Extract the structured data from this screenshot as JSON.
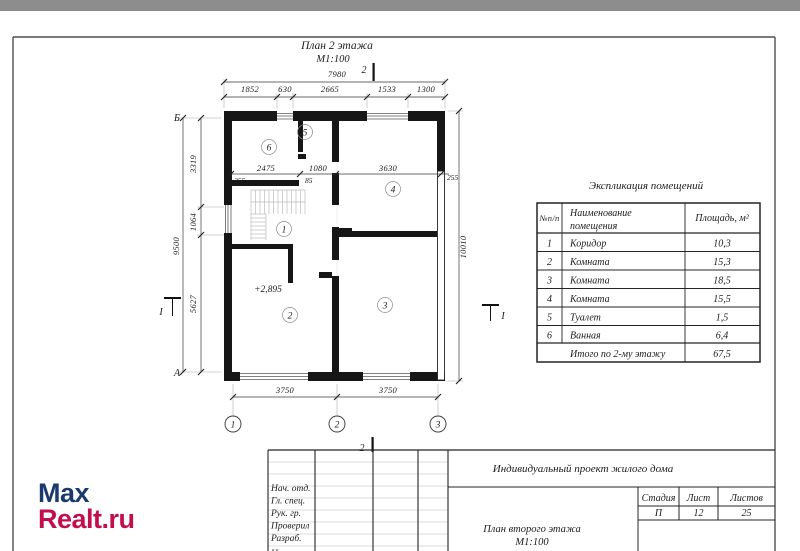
{
  "sheet": {
    "top_strip_color": "#8d8d8d"
  },
  "logo": {
    "word1": "Max",
    "word2": "Realt.ru",
    "color1": "#1a3a6e",
    "color2": "#c30e4d"
  },
  "plan": {
    "title": "План 2 этажа",
    "scale": "М1:100",
    "elevation": "+2,895",
    "axis_letters": [
      "Б",
      "А"
    ],
    "axis_numbers": [
      "1",
      "2",
      "3"
    ],
    "section_vertical": "2",
    "section_horizontal": "I",
    "rooms": [
      "1",
      "2",
      "3",
      "4",
      "5",
      "6"
    ],
    "dims": {
      "top_overall": "7980",
      "top_segments": [
        "1852",
        "630",
        "2665",
        "1533",
        "1300"
      ],
      "left_overall": "9500",
      "left_segments": [
        "3319",
        "1064",
        "5627"
      ],
      "right_overall": "10010",
      "bottom_segments": [
        "3750",
        "3750"
      ],
      "interior": [
        "2475",
        "1080",
        "3630"
      ],
      "interior_small": [
        "255",
        "85"
      ],
      "wall_thickness": "255"
    }
  },
  "explication": {
    "title": "Экспликация помещений",
    "headers": {
      "num": "№п/п",
      "name_line1": "Наименование",
      "name_line2": "помещения",
      "area": "Площадь, м²"
    },
    "rows": [
      [
        "1",
        "Коридор",
        "10,3"
      ],
      [
        "2",
        "Комната",
        "15,3"
      ],
      [
        "3",
        "Комната",
        "18,5"
      ],
      [
        "4",
        "Комната",
        "15,5"
      ],
      [
        "5",
        "Туалет",
        "1,5"
      ],
      [
        "6",
        "Ванная",
        "6,4"
      ]
    ],
    "total_label": "Итого по 2-му этажу",
    "total_value": "67,5"
  },
  "title_block": {
    "project": "Индивидуальный проект жилого дома",
    "stage_label": "Стадия",
    "sheet_label": "Лист",
    "sheets_label": "Листов",
    "stage": "П",
    "sheet": "12",
    "sheets": "25",
    "drawing_title": "План второго этажа",
    "drawing_scale": "М1:100",
    "roles": [
      "Нач. отд.",
      "Гл. спец.",
      "Рук. гр.",
      "Проверил",
      "Разраб.",
      "Н. контр."
    ]
  }
}
